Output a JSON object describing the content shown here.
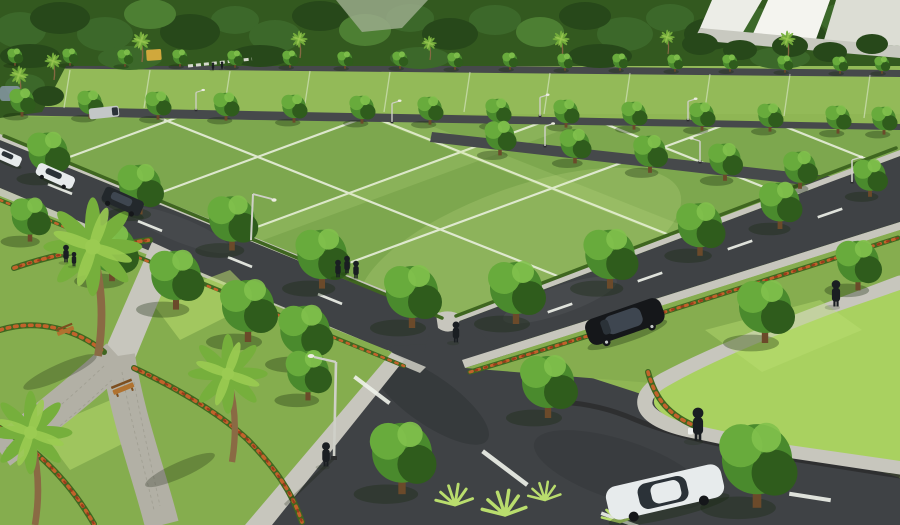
{
  "scene": {
    "kind": "3d-architectural-render",
    "subject": "aerial view of a plotted land development with lawn parcels, tree-lined asphalt roads, landscaped park, pedestrians and cars",
    "objects": [
      "background-forest",
      "white-buildings",
      "lawn-plot-grid",
      "white-plot-lines",
      "asphalt-roads",
      "white-lane-dashes",
      "concrete-sidewalks",
      "stone-walkway",
      "street-trees",
      "palm-trees",
      "flower-hedges",
      "wooden-bench",
      "street-lamps",
      "pedestrians",
      "black-sedan",
      "white-sedan",
      "dark-suv",
      "white-hatchbacks",
      "white-van",
      "grass-tufts",
      "pond",
      "white-fence",
      "yellow-play-structure"
    ]
  },
  "colors": {
    "background_forest": "#33591f",
    "forest_dark": "#27481a",
    "forest_mid": "#3c682a",
    "forest_light": "#4d7f33",
    "plot_green": "#8fb654",
    "plot_green_back": "#93ba58",
    "block_green": "#7da74e",
    "block_highlight": "#d9f09a",
    "plot_line": "#eef3e4",
    "lawn_bright": "#a9d160",
    "lawn_light": "#bfe276",
    "road": "#3f4245",
    "road_dark": "#2e3133",
    "road_light": "#565a5d",
    "road_line": "#eef1ea",
    "sidewalk": "#c7c6bd",
    "stone_path": "#b2b0a5",
    "paver_line": "#9a988c",
    "curb_dark": "#2b2c2d",
    "verge_green": "#86ad4f",
    "park_green": "#85ad4e",
    "park_light": "#b9dd6d",
    "hedge_green": "#3f6620",
    "flower_orange": "#c2622b",
    "flower_red": "#993c1c",
    "tree_mid": "#4a8a2d",
    "tree_dark": "#2f5c1c",
    "tree_light": "#68ab3c",
    "tree_light2": "#82c14c",
    "tree_trunk": "#6b4a2a",
    "tree_shadow": "rgba(22,38,12,0.33)",
    "palm_frond": "#76af3c",
    "palm_frond_light": "#9bcb52",
    "palm_trunk": "#8a6a44",
    "bench_wood": "#b0722f",
    "bench_dark": "#7c4e1f",
    "lamp_metal": "#cfd0c8",
    "lamp_head": "#ecece0",
    "car_white": "#e7ebec",
    "car_glass": "#2b3238",
    "car_black": "#15171a",
    "car_black_hl": "#3e4650",
    "suv_gray": "#23282c",
    "van_gray": "#c3c7c7",
    "person_dark": "#1a1e22",
    "bag_white": "#eef0ee",
    "building_a": "#ecede7",
    "building_b": "#f4f4ef",
    "building_c": "#dcddd4",
    "building_d": "#c8c9c0",
    "pond_blue": "#8698a4",
    "fence_white": "#e8e8e0",
    "play_yellow": "#d0a83c",
    "shadow_soft": "rgba(15,25,8,0.25)",
    "back_road": "#46494b",
    "gap_road": "#9fae90"
  }
}
